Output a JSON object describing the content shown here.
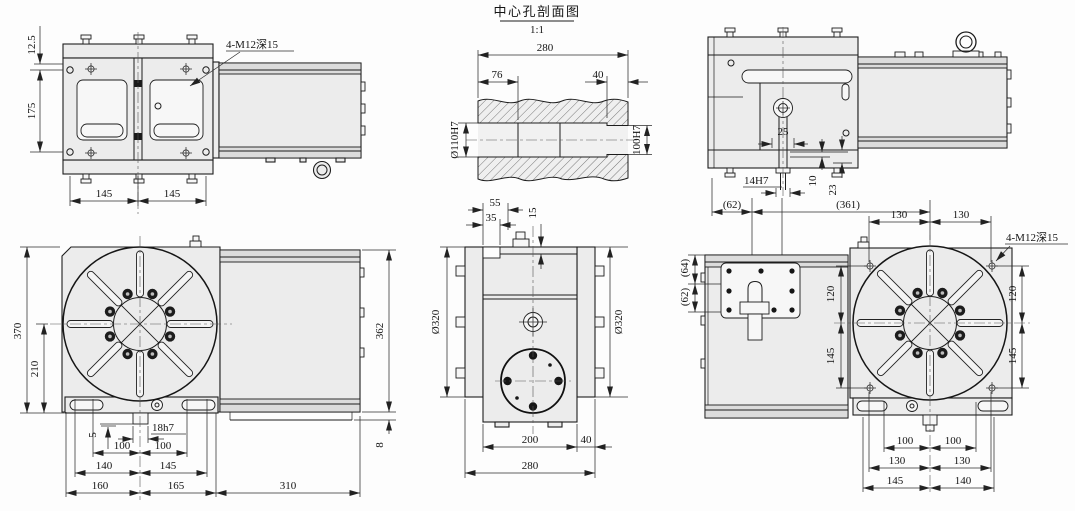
{
  "drawing_title": {
    "section_view": "中心孔剖面图",
    "scale": "1:1"
  },
  "front_view": {
    "thread_note": "4-M12深15",
    "height_offset": "12.5",
    "side_height": "175",
    "span_left": "145",
    "span_right": "145"
  },
  "section_view": {
    "overall_width": "280",
    "bore_depth_left": "76",
    "bore_depth_right": "40",
    "bore_left": "Ø110H7",
    "bore_right": "100H7"
  },
  "top_view": {
    "key_center": "25",
    "key_slot": "14H7",
    "offset_a": "10",
    "offset_b": "23",
    "ref_left": "(62)",
    "ref_right": "(361)"
  },
  "face_view": {
    "overall_height": "370",
    "center_height": "210",
    "body_height": "362",
    "base_step": "8",
    "key_depth": "5",
    "key_width": "18h7",
    "slot_100_left": "100",
    "slot_100_right": "100",
    "span_140": "140",
    "span_145": "145",
    "span_160": "160",
    "span_165": "165",
    "span_310": "310"
  },
  "side_view": {
    "offset_55": "55",
    "offset_35": "35",
    "offset_15": "15",
    "dia_left": "Ø320",
    "dia_right": "Ø320",
    "width_200": "200",
    "width_40": "40",
    "width_280": "280"
  },
  "rear_view": {
    "ref_64": "(64)",
    "ref_62": "(62)",
    "top_130_left": "130",
    "top_130_right": "130",
    "thread_note": "4-M12深15",
    "left_120": "120",
    "left_145": "145",
    "right_120": "120",
    "right_145": "145",
    "bottom_100_left": "100",
    "bottom_100_right": "100",
    "bottom_130_left": "130",
    "bottom_130_right": "130",
    "bottom_145": "145",
    "bottom_140": "140"
  }
}
